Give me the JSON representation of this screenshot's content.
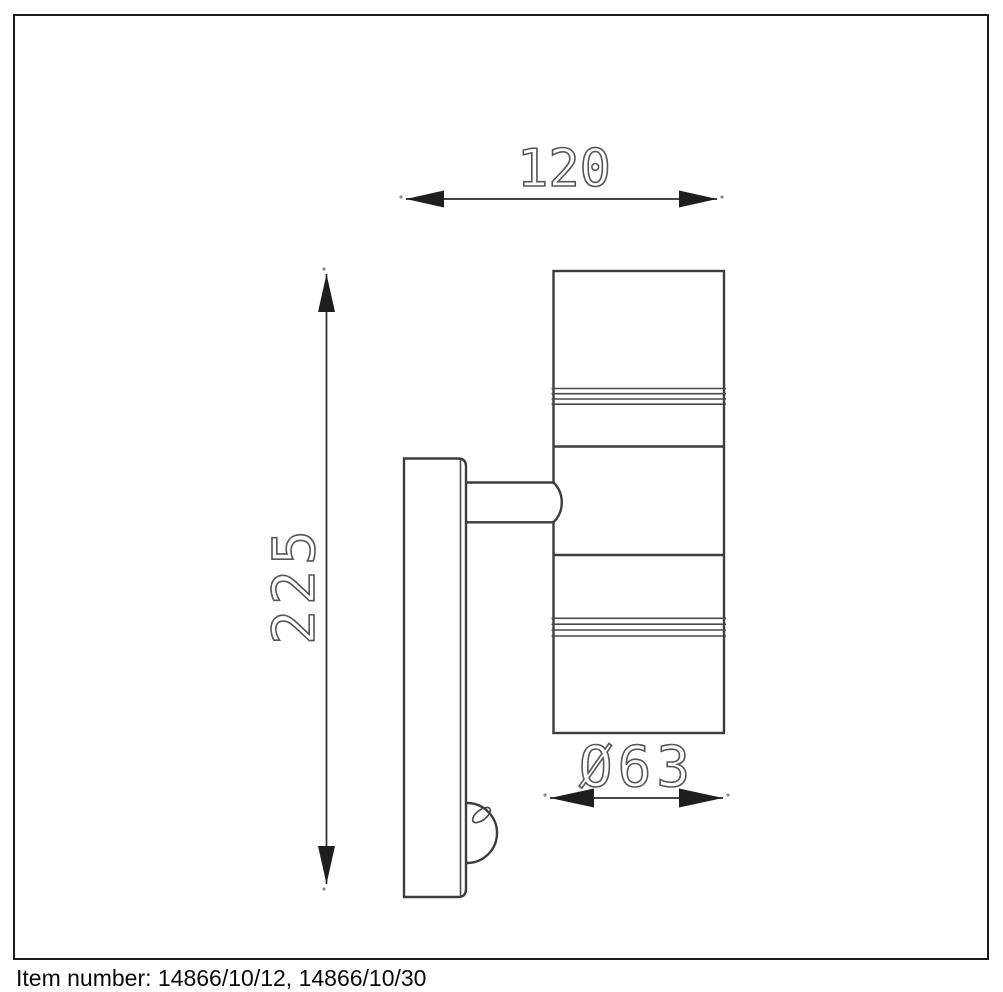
{
  "dims": {
    "width": "120",
    "height": "225",
    "diameter": "Ø63"
  },
  "footer": {
    "item_number": "Item number: 14866/10/12, 14866/10/30"
  },
  "colors": {
    "background": "#ffffff",
    "outline": "#3d3d3d",
    "dimension_lines": "#2b2b2b",
    "dimension_text": "#565656",
    "frame": "#1c1c1c",
    "footer_text": "#0a0a0a"
  }
}
